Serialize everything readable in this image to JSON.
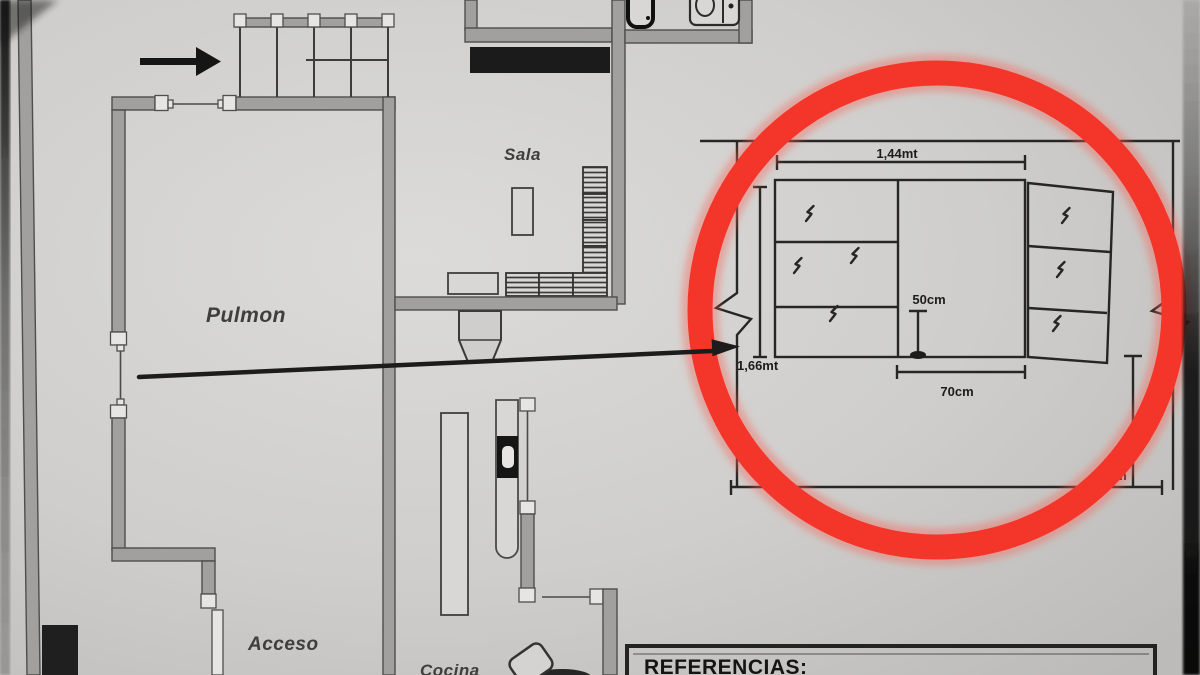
{
  "photo": {
    "description": "Photograph of a printed apartment floor plan with a cabinet detail highlighted by a hand-drawn red circle",
    "accent_red": "#f43529",
    "paper_color": "#d2d1cf",
    "ink_color": "#262624"
  },
  "plan": {
    "labels": {
      "pulmon": "Pulmon",
      "sala": "Sala",
      "acceso": "Acceso",
      "cocina": "Cocina"
    },
    "references_title": "REFERENCIAS:"
  },
  "detail_callout": {
    "dim_top_width": "1,44mt",
    "dim_left_height": "1,66mt",
    "dim_inner_height": "50cm",
    "dim_inner_width": "70cm",
    "dim_right_height": "90cm"
  },
  "icons": {
    "direction_arrow": "arrow-right-icon",
    "callout_arrow": "long-arrow-right-icon",
    "highlight": "red-circle-highlight-icon",
    "toilet": "toilet-icon",
    "bidet": "bidet-icon"
  }
}
